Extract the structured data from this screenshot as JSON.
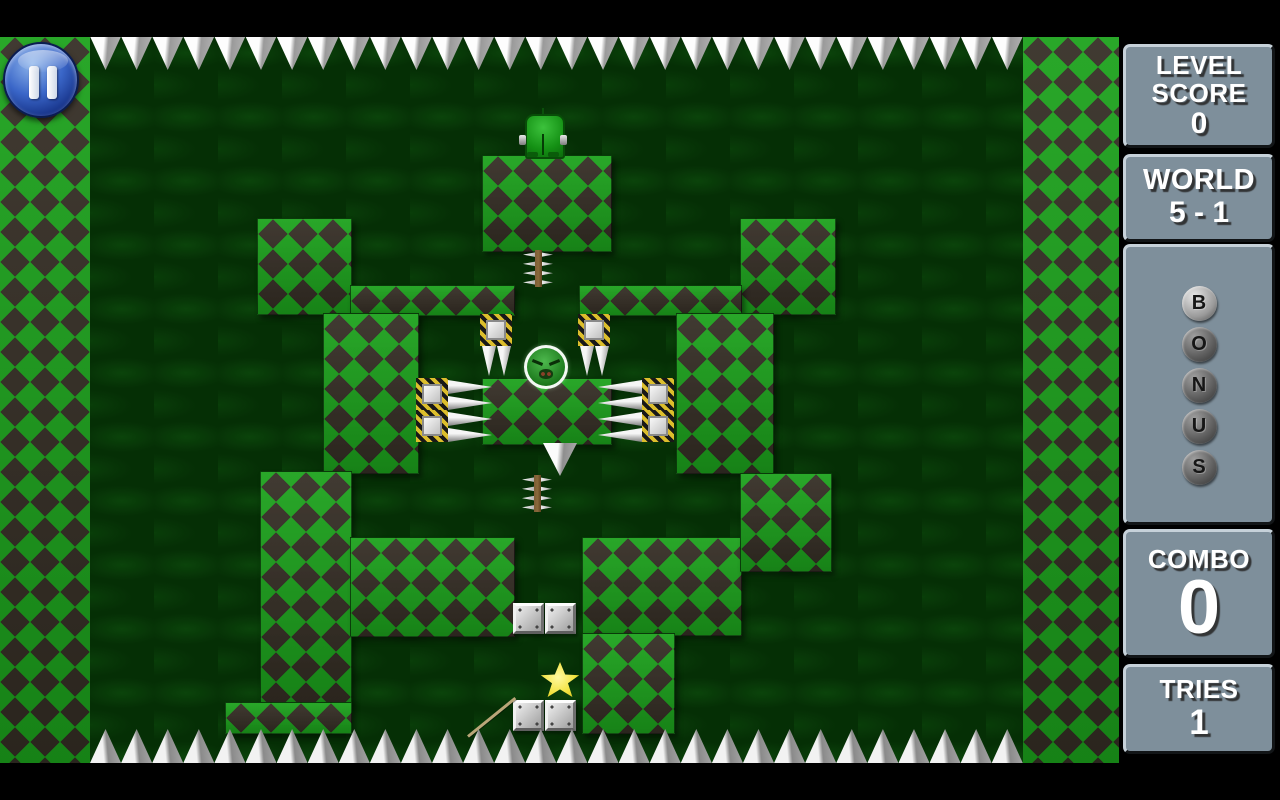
{
  "hud": {
    "level_score": {
      "label": [
        "LEVEL",
        "SCORE"
      ],
      "value": "0"
    },
    "world": {
      "label": "WORLD",
      "value": "5 - 1"
    },
    "bonus": {
      "letters": [
        "B",
        "O",
        "N",
        "U",
        "S"
      ],
      "lit": [
        true,
        false,
        false,
        false,
        false
      ]
    },
    "combo": {
      "label": "COMBO",
      "value": "0"
    },
    "tries": {
      "label": "TRIES",
      "value": "1"
    }
  },
  "controls": {
    "pause_icon": "pause-icon"
  },
  "entities": {
    "player": "green-soldier",
    "enemy": "green-blob-enemy",
    "goal": "gold-star"
  },
  "colors": {
    "tile_green": "#1ca21c",
    "tile_dark": "#352e25",
    "arena_bg": "#052f05",
    "panel_fill": "#7e8f9b",
    "panel_border_light": "#c6d1d9",
    "pause_blue": "#3a66c8",
    "hazard_yellow": "#dcbe2c",
    "star_yellow": "#f2e23c",
    "spike_gray": "#b5b5b5"
  }
}
